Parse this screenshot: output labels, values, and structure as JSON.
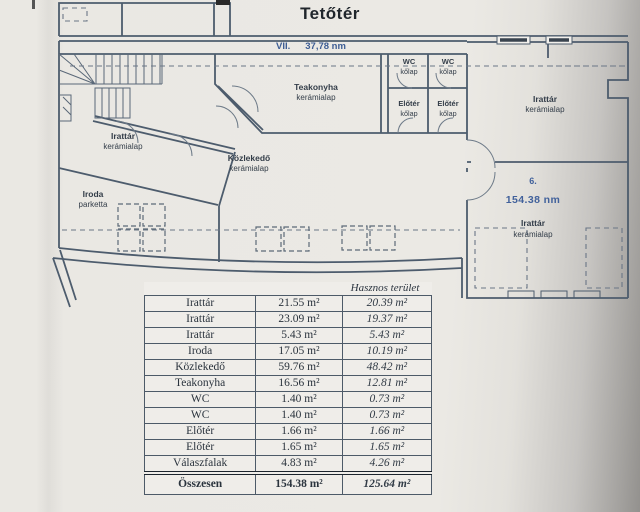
{
  "page": {
    "title": "Tetőtér"
  },
  "plan": {
    "corridor": {
      "number": "VII.",
      "area": "37,78 nm"
    },
    "rooms": {
      "teakonyha": {
        "name": "Teakonyha",
        "finish": "kerámialap"
      },
      "wc1": {
        "name": "WC",
        "finish": "kőlap"
      },
      "wc2": {
        "name": "WC",
        "finish": "kőlap"
      },
      "eloter1": {
        "name": "Előtér",
        "finish": "kőlap"
      },
      "eloter2": {
        "name": "Előtér",
        "finish": "kőlap"
      },
      "irattar_top_right": {
        "name": "Irattár",
        "finish": "kerámialap"
      },
      "irattar_left": {
        "name": "Irattár",
        "finish": "kerámialap"
      },
      "iroda": {
        "name": "Iroda",
        "finish": "parketta"
      },
      "kozlekedo": {
        "name": "Közlekedő",
        "finish": "kerámialap"
      },
      "unit6": {
        "number": "6.",
        "area": "154.38 nm",
        "name": "Irattár",
        "finish": "kerámialap"
      }
    }
  },
  "table": {
    "header": "Hasznos terület",
    "rows": [
      {
        "name": "Irattár",
        "gross": "21.55 m²",
        "net": "20.39 m²"
      },
      {
        "name": "Irattár",
        "gross": "23.09 m²",
        "net": "19.37 m²"
      },
      {
        "name": "Irattár",
        "gross": "5.43 m²",
        "net": "5.43 m²"
      },
      {
        "name": "Iroda",
        "gross": "17.05 m²",
        "net": "10.19 m²"
      },
      {
        "name": "Közlekedő",
        "gross": "59.76 m²",
        "net": "48.42 m²"
      },
      {
        "name": "Teakonyha",
        "gross": "16.56 m²",
        "net": "12.81 m²"
      },
      {
        "name": "WC",
        "gross": "1.40 m²",
        "net": "0.73 m²"
      },
      {
        "name": "WC",
        "gross": "1.40 m²",
        "net": "0.73 m²"
      },
      {
        "name": "Előtér",
        "gross": "1.66 m²",
        "net": "1.66 m²"
      },
      {
        "name": "Előtér",
        "gross": "1.65 m²",
        "net": "1.65 m²"
      },
      {
        "name": "Válaszfalak",
        "gross": "4.83 m²",
        "net": "4.26 m²"
      }
    ],
    "total": {
      "name": "Összesen",
      "gross": "154.38 m²",
      "net": "125.64 m²"
    }
  }
}
